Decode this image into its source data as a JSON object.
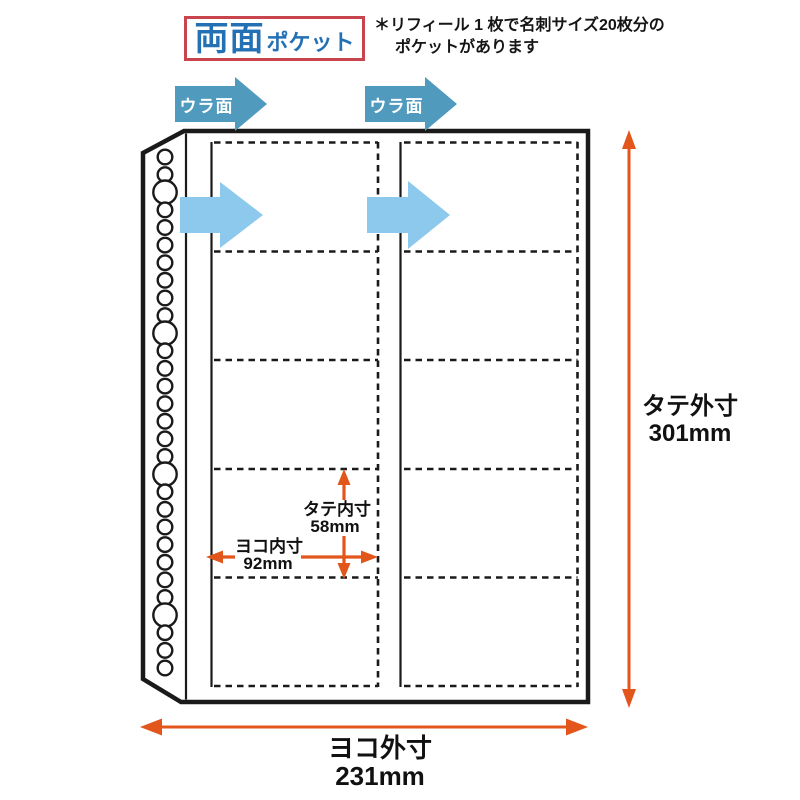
{
  "title": {
    "emphasis": "両面",
    "suffix": "ポケット"
  },
  "note": {
    "line1": "＊リフィール 1 枚で名刺サイズ20枚分の",
    "line2": "ポケットがあります"
  },
  "back_side": {
    "left_label": "ウラ面",
    "right_label": "ウラ面"
  },
  "dimensions": {
    "outer_height": {
      "label": "タテ外寸",
      "value": "301mm"
    },
    "outer_width": {
      "label": "ヨコ外寸",
      "value": "231mm"
    },
    "inner_height": {
      "label": "タテ内寸",
      "value": "58mm"
    },
    "inner_width": {
      "label": "ヨコ内寸",
      "value": "92mm"
    }
  },
  "sheet": {
    "columns": 2,
    "pockets_per_column": 5,
    "binding_holes": 30
  },
  "colors": {
    "title_blue": "#2470b5",
    "title_border_red": "#c9454e",
    "back_arrow_blue": "#4f9abd",
    "pocket_arrow_blue": "#8cc9ec",
    "dimension_orange": "#e2561b",
    "line_black": "#1a1a1a"
  }
}
